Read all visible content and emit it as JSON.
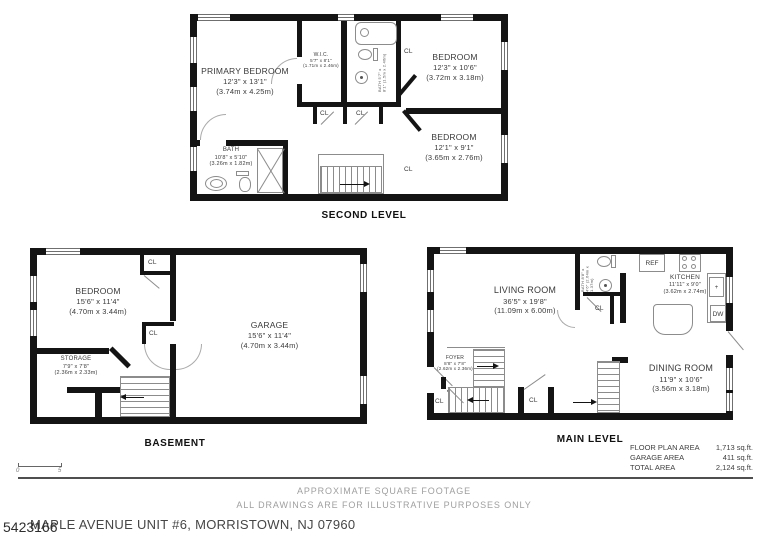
{
  "plans": {
    "second": {
      "title": "SECOND LEVEL",
      "primary_bedroom": {
        "name": "PRIMARY BEDROOM",
        "dims": "12'3\" x 13'1\"",
        "metric": "(3.74m x 4.25m)"
      },
      "wic": {
        "name": "W.I.C.",
        "dims": "5'7\" x 8'1\"",
        "metric": "(1.71m x 2.46m)"
      },
      "bath_top": {
        "name": "BATH",
        "dims": "5'7\" x 8'1\"",
        "metric": "(1.5m x 2.46m)"
      },
      "bedroom_right_top": {
        "name": "BEDROOM",
        "dims": "12'3\" x 10'6\"",
        "metric": "(3.72m x 3.18m)"
      },
      "bedroom_right_bottom": {
        "name": "BEDROOM",
        "dims": "12'1\" x 9'1\"",
        "metric": "(3.65m x 2.76m)"
      },
      "bath": {
        "name": "BATH",
        "dims": "10'8\" x 5'10\"",
        "metric": "(3.26m x 1.82m)"
      }
    },
    "basement": {
      "title": "BASEMENT",
      "bedroom": {
        "name": "BEDROOM",
        "dims": "15'6\" x 11'4\"",
        "metric": "(4.70m x 3.44m)"
      },
      "garage": {
        "name": "GARAGE",
        "dims": "15'6\" x 11'4\"",
        "metric": "(4.70m x 3.44m)"
      },
      "storage": {
        "name": "STORAGE",
        "dims": "7'9\" x 7'8\"",
        "metric": "(2.36m x 2.33m)"
      }
    },
    "main": {
      "title": "MAIN LEVEL",
      "living": {
        "name": "LIVING ROOM",
        "dims": "36'5\" x 19'8\"",
        "metric": "(11.09m x 6.00m)"
      },
      "kitchen": {
        "name": "KITCHEN",
        "dims": "11'11\" x 9'0\"",
        "metric": "(3.62m x 2.74m)"
      },
      "dining": {
        "name": "DINING ROOM",
        "dims": "11'9\" x 10'6\"",
        "metric": "(3.56m x 3.18m)"
      },
      "foyer": {
        "name": "FOYER",
        "dims": "8'8\" x 7'8\"",
        "metric": "(2.62m x 2.36m)"
      },
      "bath": {
        "name": "BATH",
        "dims": "8'8\" x 4'6\"",
        "metric": "(2.64m x 1.37m)"
      },
      "ref": "REF",
      "dw": "DW",
      "plus_mark": "+"
    }
  },
  "labels": {
    "closet": "CL"
  },
  "area_table": {
    "rows": [
      {
        "label": "FLOOR PLAN AREA",
        "value": "1,713 sq.ft."
      },
      {
        "label": "GARAGE AREA",
        "value": "411 sq.ft."
      },
      {
        "label": "TOTAL AREA",
        "value": "2,124 sq.ft."
      }
    ]
  },
  "scale_bar": {
    "start": "0",
    "end": "5"
  },
  "footer": {
    "line1": "APPROXIMATE SQUARE FOOTAGE",
    "line2": "ALL DRAWINGS ARE FOR ILLUSTRATIVE PURPOSES ONLY",
    "watermark": "5423166",
    "address": "MAPLE AVENUE UNIT #6, MORRISTOWN, NJ 07960"
  }
}
